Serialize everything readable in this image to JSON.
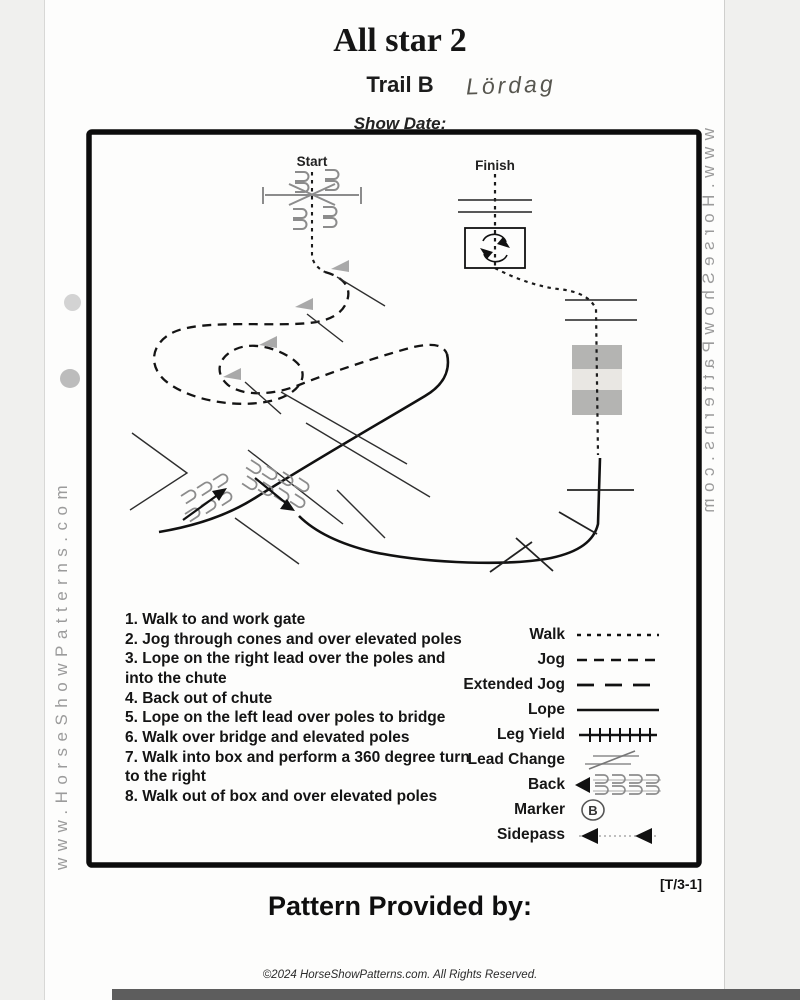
{
  "header": {
    "title": "All star 2",
    "trail": "Trail B",
    "handwritten_note": "Lördag",
    "show_date_label": "Show Date:"
  },
  "watermark": {
    "text": "www.HorseShowPatterns.com"
  },
  "diagram": {
    "start_label": "Start",
    "finish_label": "Finish"
  },
  "instructions": [
    "1. Walk to and work gate",
    "2. Jog through cones and over elevated poles",
    "3. Lope on the right lead over the poles and into the chute",
    "4. Back out of chute",
    "5. Lope on the left lead over poles to bridge",
    "6. Walk over bridge and elevated poles",
    "7. Walk into box and perform a 360 degree turn to the right",
    "8. Walk out of box and over elevated poles"
  ],
  "legend": {
    "marker_letter": "B",
    "items": [
      {
        "label": "Walk",
        "symbol": "walk-dotted-line"
      },
      {
        "label": "Jog",
        "symbol": "jog-dashed-line"
      },
      {
        "label": "Extended Jog",
        "symbol": "extended-jog-long-dash-line"
      },
      {
        "label": "Lope",
        "symbol": "lope-solid-line"
      },
      {
        "label": "Leg Yield",
        "symbol": "leg-yield-hatched-line"
      },
      {
        "label": "Lead Change",
        "symbol": "lead-change-slash"
      },
      {
        "label": "Back",
        "symbol": "back-arrow-with-hooks"
      },
      {
        "label": "Marker",
        "symbol": "marker-circle-letter"
      },
      {
        "label": "Sidepass",
        "symbol": "sidepass-double-arrow"
      }
    ]
  },
  "footer": {
    "pattern_code": "[T/3-1]",
    "provided_by_label": "Pattern Provided by:",
    "copyright": "©2024 HorseShowPatterns.com. All Rights Reserved."
  },
  "colors": {
    "ink": "#141414",
    "gray_obstacle": "#8c8c8c",
    "bridge_gray": "#b4b4b2",
    "bridge_band": "#e9e7e3",
    "watermark_gray": "#9b9b9b",
    "cone_gray": "#a9a9a9"
  }
}
